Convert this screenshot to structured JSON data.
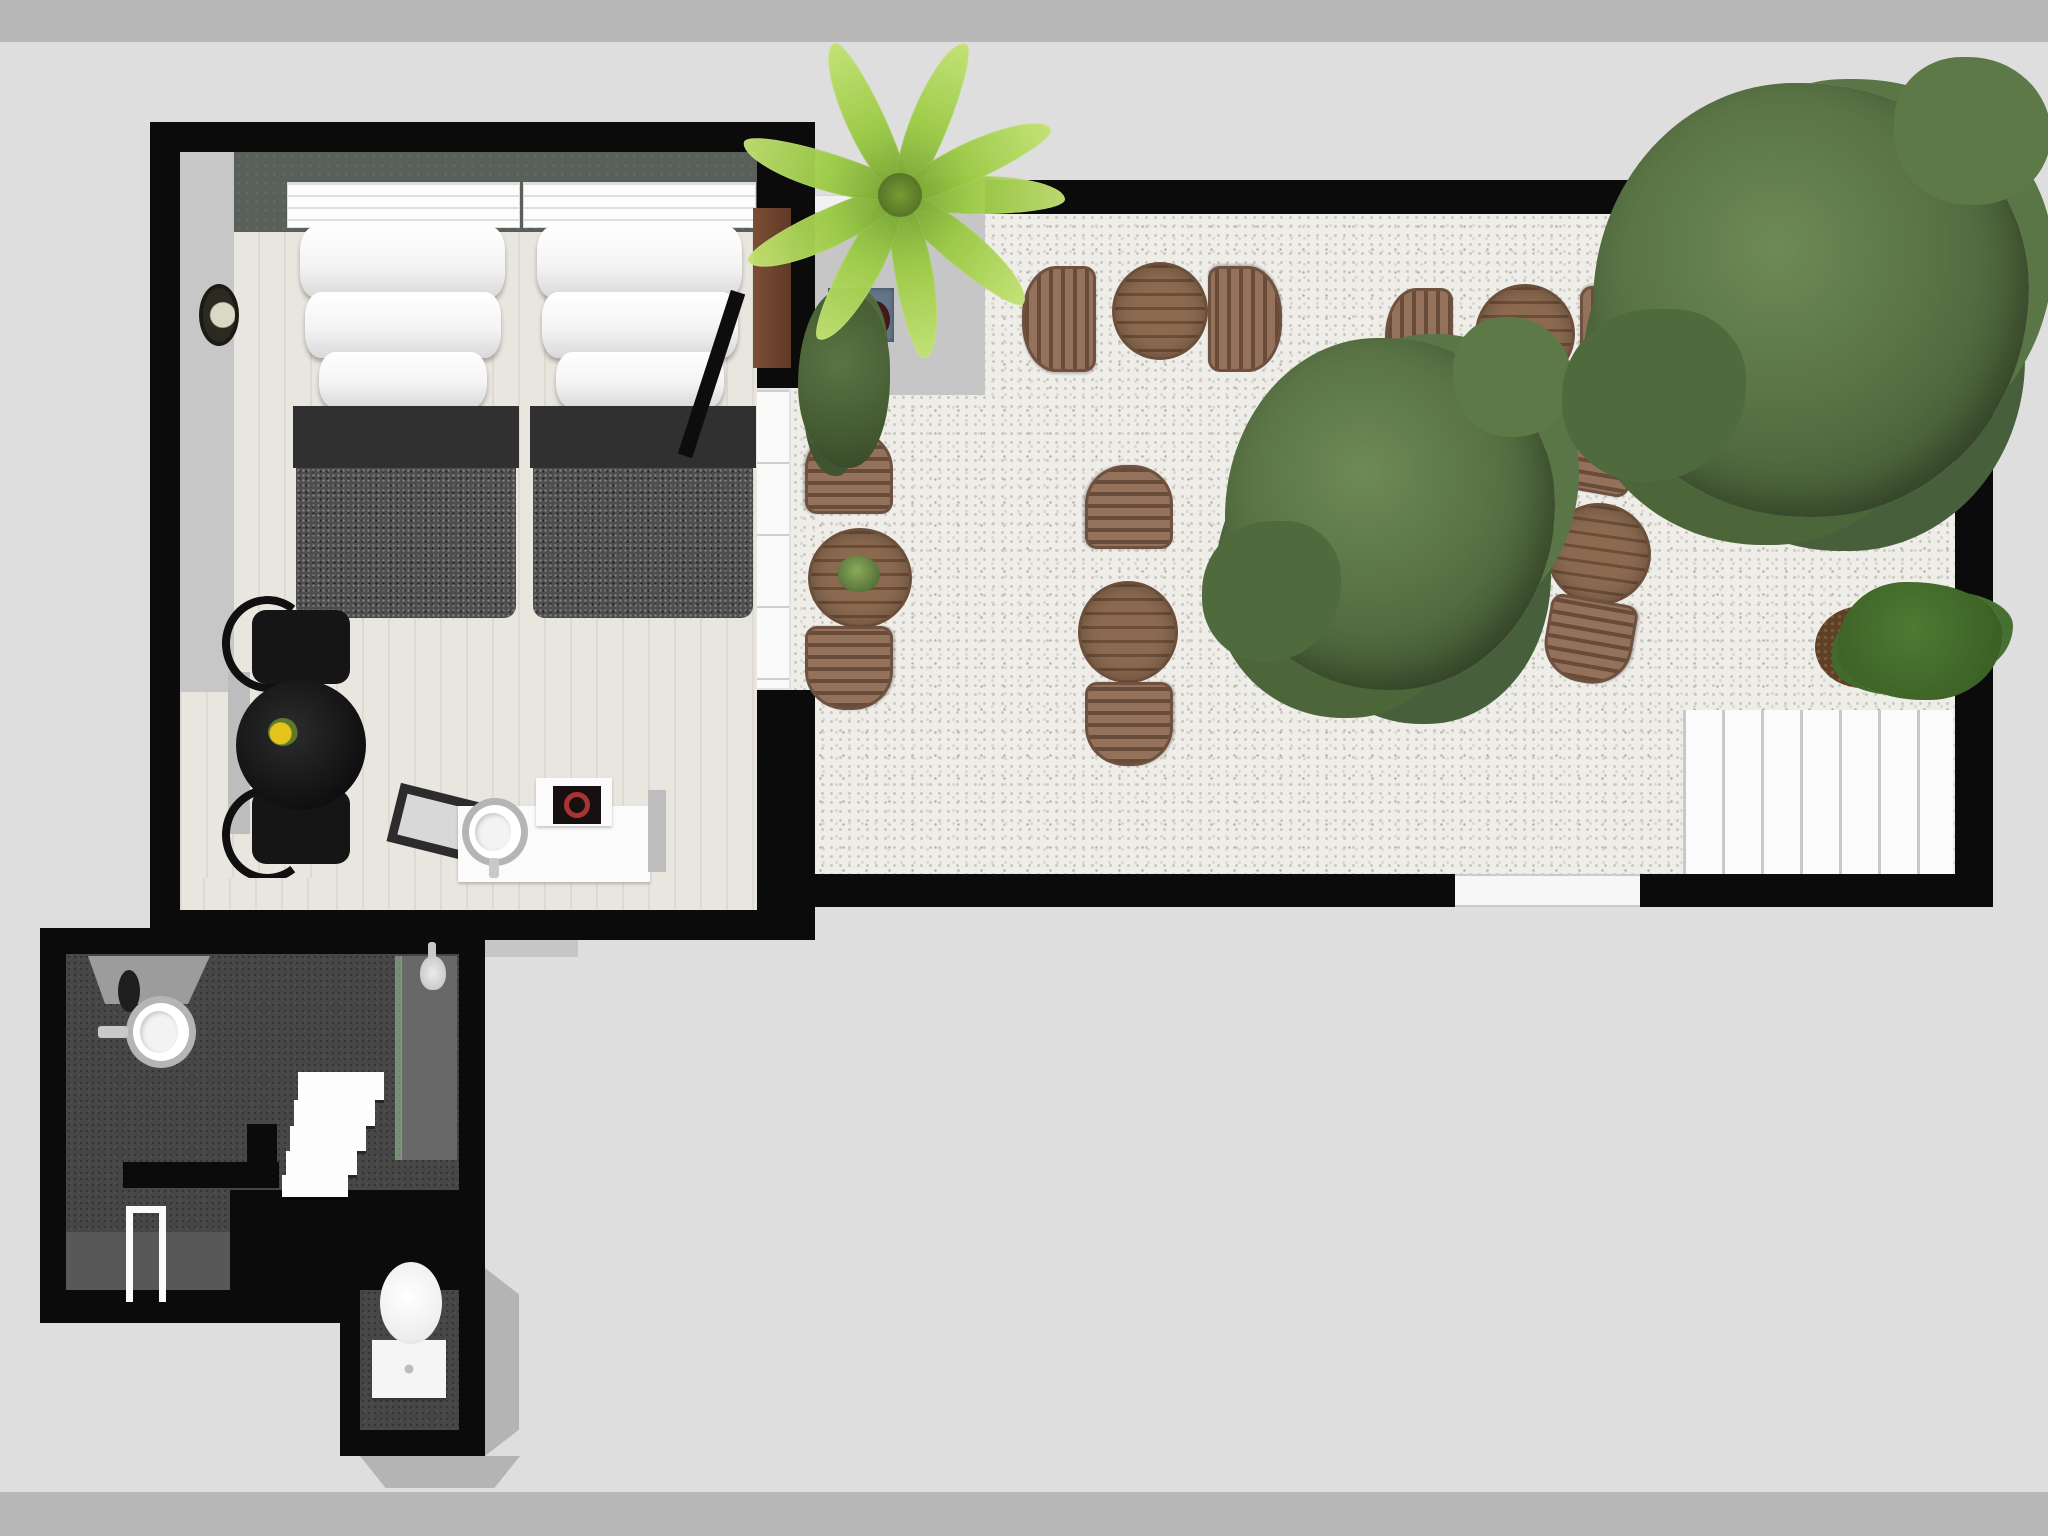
{
  "palette": {
    "background": "#dedede",
    "frame_bands": "#b8b8b8",
    "walls": "#0b0b0b",
    "bedroom_floor": "#e9e6df",
    "headboard_wall": "#59605a",
    "duvet": "#4e4e4e",
    "gravel": "#efede8",
    "wood_furniture": "#8b6a50",
    "tree_green": "#587244",
    "palm_green": "#9ccb45",
    "bathroom_floor": "#474747",
    "accent_red_ring": "#a93434",
    "flower_yellow": "#e6c31c"
  },
  "scene": {
    "description": "top-down 3D floor plan: bedroom with two beds, dark en-suite bathroom below, gravel patio terrace with five wooden bistro table sets, trees and white deck",
    "items": [
      {
        "n": "outdoor-path",
        "t": "path",
        "x": 360,
        "y": 905,
        "w": 218,
        "h": 52
      },
      {
        "n": "patio-gravel-floor",
        "t": "gravel",
        "x": 800,
        "y": 213,
        "w": 1155,
        "h": 661
      },
      {
        "n": "patio-concrete-path",
        "t": "path",
        "x": 800,
        "y": 213,
        "w": 185,
        "h": 182
      },
      {
        "n": "patio-low-white-wall",
        "t": "curb",
        "x": 800,
        "y": 195,
        "w": 185,
        "h": 18
      },
      {
        "n": "patio-white-deck",
        "t": "deck",
        "x": 1683,
        "y": 710,
        "w": 270,
        "h": 166
      },
      {
        "n": "patio-wall-top",
        "t": "wall",
        "x": 985,
        "y": 180,
        "w": 1008,
        "h": 34
      },
      {
        "n": "patio-wall-right",
        "t": "wall",
        "x": 1955,
        "y": 180,
        "w": 38,
        "h": 727
      },
      {
        "n": "patio-wall-bottom-left",
        "t": "wall",
        "x": 788,
        "y": 874,
        "w": 667,
        "h": 33
      },
      {
        "n": "patio-door-opening",
        "t": "gap-white",
        "x": 1455,
        "y": 874,
        "w": 185,
        "h": 33
      },
      {
        "n": "patio-wall-bottom-right",
        "t": "wall",
        "x": 1640,
        "y": 874,
        "w": 353,
        "h": 33
      },
      {
        "n": "bedroom-walls",
        "t": "wall",
        "x": 150,
        "y": 122,
        "w": 665,
        "h": 818
      },
      {
        "n": "bedroom-window-band",
        "t": "window-white",
        "x": 753,
        "y": 388,
        "w": 38,
        "h": 302
      },
      {
        "n": "gravel-strip-by-window",
        "t": "gravel",
        "x": 791,
        "y": 388,
        "w": 24,
        "h": 302
      },
      {
        "n": "bedroom-floor",
        "t": "floor-wood",
        "x": 180,
        "y": 152,
        "w": 577,
        "h": 758
      },
      {
        "n": "bedroom-left-wall-face",
        "t": "face-gray",
        "x": 180,
        "y": 152,
        "w": 54,
        "h": 540
      },
      {
        "n": "bedroom-headboard-wall",
        "t": "band-slate",
        "x": 234,
        "y": 152,
        "w": 523,
        "h": 80
      },
      {
        "n": "bed-left-valance",
        "t": "valance",
        "x": 287,
        "y": 182,
        "w": 233,
        "h": 46
      },
      {
        "n": "bed-right-valance",
        "t": "valance",
        "x": 523,
        "y": 182,
        "w": 233,
        "h": 46
      },
      {
        "n": "pillow",
        "t": "pillow",
        "x": 300,
        "y": 226,
        "w": 205,
        "h": 72
      },
      {
        "n": "pillow",
        "t": "pillow",
        "x": 305,
        "y": 292,
        "w": 196,
        "h": 66
      },
      {
        "n": "pillow",
        "t": "pillow",
        "x": 319,
        "y": 352,
        "w": 168,
        "h": 56
      },
      {
        "n": "bed-left-fold",
        "t": "bed-band",
        "x": 293,
        "y": 406,
        "w": 226,
        "h": 62
      },
      {
        "n": "bed-left-duvet",
        "t": "duvet",
        "x": 296,
        "y": 468,
        "w": 220,
        "h": 150
      },
      {
        "n": "pillow",
        "t": "pillow",
        "x": 537,
        "y": 226,
        "w": 205,
        "h": 72
      },
      {
        "n": "pillow",
        "t": "pillow",
        "x": 542,
        "y": 292,
        "w": 196,
        "h": 66
      },
      {
        "n": "pillow",
        "t": "pillow",
        "x": 556,
        "y": 352,
        "w": 168,
        "h": 56
      },
      {
        "n": "bed-right-fold",
        "t": "bed-band",
        "x": 530,
        "y": 406,
        "w": 226,
        "h": 62
      },
      {
        "n": "bed-right-duvet",
        "t": "duvet",
        "x": 533,
        "y": 468,
        "w": 220,
        "h": 150
      },
      {
        "n": "wall-clock",
        "t": "clock",
        "x": 199,
        "y": 284,
        "w": 40,
        "h": 62
      },
      {
        "n": "shelf-plank",
        "t": "plank",
        "x": 228,
        "y": 672,
        "w": 22,
        "h": 162
      },
      {
        "n": "chair-back-arc",
        "t": "arc-black",
        "x": 222,
        "y": 596,
        "w": 92,
        "h": 96,
        "r": -8
      },
      {
        "n": "chair-back-arc",
        "t": "arc-black",
        "x": 222,
        "y": 786,
        "w": 92,
        "h": 96,
        "r": 8
      },
      {
        "n": "black-chair",
        "t": "chair-black",
        "x": 252,
        "y": 610,
        "w": 98,
        "h": 74
      },
      {
        "n": "black-chair",
        "t": "chair-black",
        "x": 252,
        "y": 790,
        "w": 98,
        "h": 74
      },
      {
        "n": "black-round-table",
        "t": "table-black",
        "x": 236,
        "y": 680,
        "w": 130,
        "h": 130
      },
      {
        "n": "flower-vase",
        "t": "flower",
        "x": 268,
        "y": 718,
        "w": 30,
        "h": 28
      },
      {
        "n": "floor-tray",
        "t": "tray",
        "x": 392,
        "y": 796,
        "w": 116,
        "h": 60,
        "r": 14
      },
      {
        "n": "vanity-counter",
        "t": "white-box",
        "x": 458,
        "y": 806,
        "w": 192,
        "h": 76
      },
      {
        "n": "vanity-sink",
        "t": "sink-ring",
        "x": 462,
        "y": 798,
        "w": 66,
        "h": 68
      },
      {
        "n": "vanity-faucet",
        "t": "faucet",
        "x": 489,
        "y": 858,
        "w": 10,
        "h": 20
      },
      {
        "n": "side-cabinet",
        "t": "white-box",
        "x": 536,
        "y": 778,
        "w": 76,
        "h": 48
      },
      {
        "n": "cabinet-screen",
        "t": "screen",
        "x": 553,
        "y": 786,
        "w": 48,
        "h": 38
      },
      {
        "n": "door-post",
        "t": "plank",
        "x": 648,
        "y": 790,
        "w": 18,
        "h": 82
      },
      {
        "n": "bedroom-entry-door",
        "t": "door-wood",
        "x": 753,
        "y": 208,
        "w": 38,
        "h": 160
      },
      {
        "n": "open-door-leaf",
        "t": "door-leaf",
        "x": 704,
        "y": 288,
        "w": 15,
        "h": 172,
        "r": 18
      },
      {
        "n": "bathroom-walls-main",
        "t": "wall",
        "x": 40,
        "y": 928,
        "w": 445,
        "h": 395
      },
      {
        "n": "bathroom-walls-nook",
        "t": "wall",
        "x": 340,
        "y": 1323,
        "w": 145,
        "h": 133
      },
      {
        "n": "bathroom-face-right",
        "t": "face3d fr",
        "x": 485,
        "y": 1268,
        "w": 34,
        "h": 188
      },
      {
        "n": "bathroom-face-bottom",
        "t": "face3d fb",
        "x": 360,
        "y": 1456,
        "w": 160,
        "h": 32
      },
      {
        "n": "bathroom-floor",
        "t": "bath-floor",
        "x": 66,
        "y": 954,
        "w": 393,
        "h": 336
      },
      {
        "n": "bathroom-hall-floor",
        "t": "bath-floor",
        "x": 360,
        "y": 1290,
        "w": 99,
        "h": 140
      },
      {
        "n": "bathroom-platform",
        "t": "bath-floor-light",
        "x": 66,
        "y": 1232,
        "w": 166,
        "h": 58
      },
      {
        "n": "bathroom-inner-wall",
        "t": "wall",
        "x": 230,
        "y": 1190,
        "w": 229,
        "h": 100
      },
      {
        "n": "bathroom-lobby",
        "t": "lobby",
        "x": 88,
        "y": 956,
        "w": 122,
        "h": 48
      },
      {
        "n": "bedroom-bath-passage",
        "t": "floor-wood",
        "x": 203,
        "y": 878,
        "w": 126,
        "h": 32
      },
      {
        "n": "shower-wall",
        "t": "shower-wall",
        "x": 401,
        "y": 956,
        "w": 56,
        "h": 204
      },
      {
        "n": "shower-glass",
        "t": "glass-green",
        "x": 395,
        "y": 956,
        "w": 7,
        "h": 204
      },
      {
        "n": "shower-stem",
        "t": "faucet",
        "x": 428,
        "y": 942,
        "w": 8,
        "h": 18
      },
      {
        "n": "shower-head",
        "t": "shower-head",
        "x": 420,
        "y": 956,
        "w": 26,
        "h": 34
      },
      {
        "n": "bath-mirror",
        "t": "mirror",
        "x": 118,
        "y": 970,
        "w": 22,
        "h": 42
      },
      {
        "n": "bath-sink",
        "t": "sink-ring",
        "x": 126,
        "y": 996,
        "w": 70,
        "h": 72
      },
      {
        "n": "bath-faucet",
        "t": "faucet",
        "x": 98,
        "y": 1026,
        "w": 30,
        "h": 12
      },
      {
        "n": "stair-step",
        "t": "step",
        "x": 298,
        "y": 1072,
        "w": 86,
        "h": 28
      },
      {
        "n": "stair-step",
        "t": "step",
        "x": 294,
        "y": 1100,
        "w": 81,
        "h": 26
      },
      {
        "n": "stair-step",
        "t": "step",
        "x": 290,
        "y": 1126,
        "w": 76,
        "h": 25
      },
      {
        "n": "stair-step",
        "t": "step",
        "x": 286,
        "y": 1151,
        "w": 71,
        "h": 24
      },
      {
        "n": "stair-step",
        "t": "step",
        "x": 282,
        "y": 1175,
        "w": 66,
        "h": 22
      },
      {
        "n": "stair-wall-stub",
        "t": "wall",
        "x": 247,
        "y": 1124,
        "w": 30,
        "h": 64
      },
      {
        "n": "bath-bench",
        "t": "wall",
        "x": 123,
        "y": 1162,
        "w": 156,
        "h": 26
      },
      {
        "n": "open-door-frame",
        "t": "door-frame",
        "x": 126,
        "y": 1206,
        "w": 40,
        "h": 96
      },
      {
        "n": "toilet-tank",
        "t": "toilet-tank",
        "x": 372,
        "y": 1340,
        "w": 74,
        "h": 58
      },
      {
        "n": "toilet-bowl",
        "t": "toilet-bowl",
        "x": 380,
        "y": 1262,
        "w": 62,
        "h": 82
      },
      {
        "n": "patio-table",
        "t": "wood-table",
        "x": 1112,
        "y": 262,
        "w": 96,
        "h": 98
      },
      {
        "n": "patio-chair",
        "t": "wood-chair side",
        "x": 1022,
        "y": 266,
        "w": 74,
        "h": 106
      },
      {
        "n": "patio-chair",
        "t": "wood-chair side",
        "x": 1208,
        "y": 266,
        "w": 74,
        "h": 106,
        "r": 180
      },
      {
        "n": "patio-table",
        "t": "wood-table",
        "x": 1475,
        "y": 284,
        "w": 100,
        "h": 100
      },
      {
        "n": "patio-chair",
        "t": "wood-chair side",
        "x": 1385,
        "y": 288,
        "w": 68,
        "h": 106
      },
      {
        "n": "patio-chair",
        "t": "wood-chair side",
        "x": 1580,
        "y": 286,
        "w": 78,
        "h": 108,
        "r": 180
      },
      {
        "n": "patio-table",
        "t": "wood-table",
        "x": 808,
        "y": 528,
        "w": 104,
        "h": 100
      },
      {
        "n": "patio-chair",
        "t": "wood-chair side",
        "x": 807,
        "y": 428,
        "w": 84,
        "h": 88,
        "r": 90
      },
      {
        "n": "patio-chair",
        "t": "wood-chair side",
        "x": 807,
        "y": 624,
        "w": 84,
        "h": 88,
        "r": -90
      },
      {
        "n": "table-plant",
        "t": "plant-top",
        "x": 838,
        "y": 556,
        "w": 42,
        "h": 36
      },
      {
        "n": "patio-table",
        "t": "wood-table",
        "x": 1078,
        "y": 581,
        "w": 100,
        "h": 102
      },
      {
        "n": "patio-chair",
        "t": "wood-chair side",
        "x": 1087,
        "y": 463,
        "w": 84,
        "h": 88,
        "r": 90
      },
      {
        "n": "patio-chair",
        "t": "wood-chair side",
        "x": 1087,
        "y": 680,
        "w": 84,
        "h": 88,
        "r": -90
      },
      {
        "n": "patio-table",
        "t": "wood-table",
        "x": 1547,
        "y": 503,
        "w": 104,
        "h": 102,
        "r": 8
      },
      {
        "n": "patio-chair",
        "t": "wood-chair side",
        "x": 1549,
        "y": 406,
        "w": 84,
        "h": 88,
        "r": 100
      },
      {
        "n": "patio-chair",
        "t": "wood-chair side",
        "x": 1547,
        "y": 597,
        "w": 84,
        "h": 88,
        "r": -80
      },
      {
        "n": "planter-box",
        "t": "planter",
        "x": 828,
        "y": 288,
        "w": 66,
        "h": 54
      },
      {
        "n": "shrub",
        "t": "bush",
        "x": 798,
        "y": 290,
        "w": 92,
        "h": 178
      },
      {
        "n": "palm-frond",
        "t": "palm-frond",
        "x": 895,
        "y": 176,
        "w": 170,
        "h": 38,
        "r": 0
      },
      {
        "n": "palm-frond",
        "t": "palm-frond",
        "x": 876,
        "y": 227,
        "w": 170,
        "h": 38,
        "r": 40
      },
      {
        "n": "palm-frond",
        "t": "palm-frond",
        "x": 829,
        "y": 255,
        "w": 170,
        "h": 38,
        "r": 80
      },
      {
        "n": "palm-frond",
        "t": "palm-frond",
        "x": 777,
        "y": 247,
        "w": 170,
        "h": 38,
        "r": 118
      },
      {
        "n": "palm-frond",
        "t": "palm-frond",
        "x": 742,
        "y": 210,
        "w": 170,
        "h": 38,
        "r": 155
      },
      {
        "n": "palm-frond",
        "t": "palm-frond",
        "x": 739,
        "y": 152,
        "w": 170,
        "h": 38,
        "r": 197
      },
      {
        "n": "palm-frond",
        "t": "palm-frond",
        "x": 781,
        "y": 103,
        "w": 170,
        "h": 38,
        "r": 245
      },
      {
        "n": "palm-frond",
        "t": "palm-frond",
        "x": 845,
        "y": 102,
        "w": 170,
        "h": 38,
        "r": 292
      },
      {
        "n": "palm-frond",
        "t": "palm-frond",
        "x": 887,
        "y": 142,
        "w": 170,
        "h": 38,
        "r": 335
      },
      {
        "n": "palm-core",
        "t": "palm-core",
        "x": 878,
        "y": 173,
        "w": 44,
        "h": 44
      },
      {
        "n": "tree-center",
        "t": "tree",
        "x": 1225,
        "y": 338,
        "w": 330,
        "h": 352
      },
      {
        "n": "mulch-bed",
        "t": "mulch",
        "x": 1815,
        "y": 606,
        "w": 95,
        "h": 82
      },
      {
        "n": "corner-shrub",
        "t": "bush2",
        "x": 1838,
        "y": 582,
        "w": 165,
        "h": 118
      },
      {
        "n": "tree-top-right",
        "t": "tree",
        "x": 1593,
        "y": 83,
        "w": 436,
        "h": 434
      }
    ]
  }
}
